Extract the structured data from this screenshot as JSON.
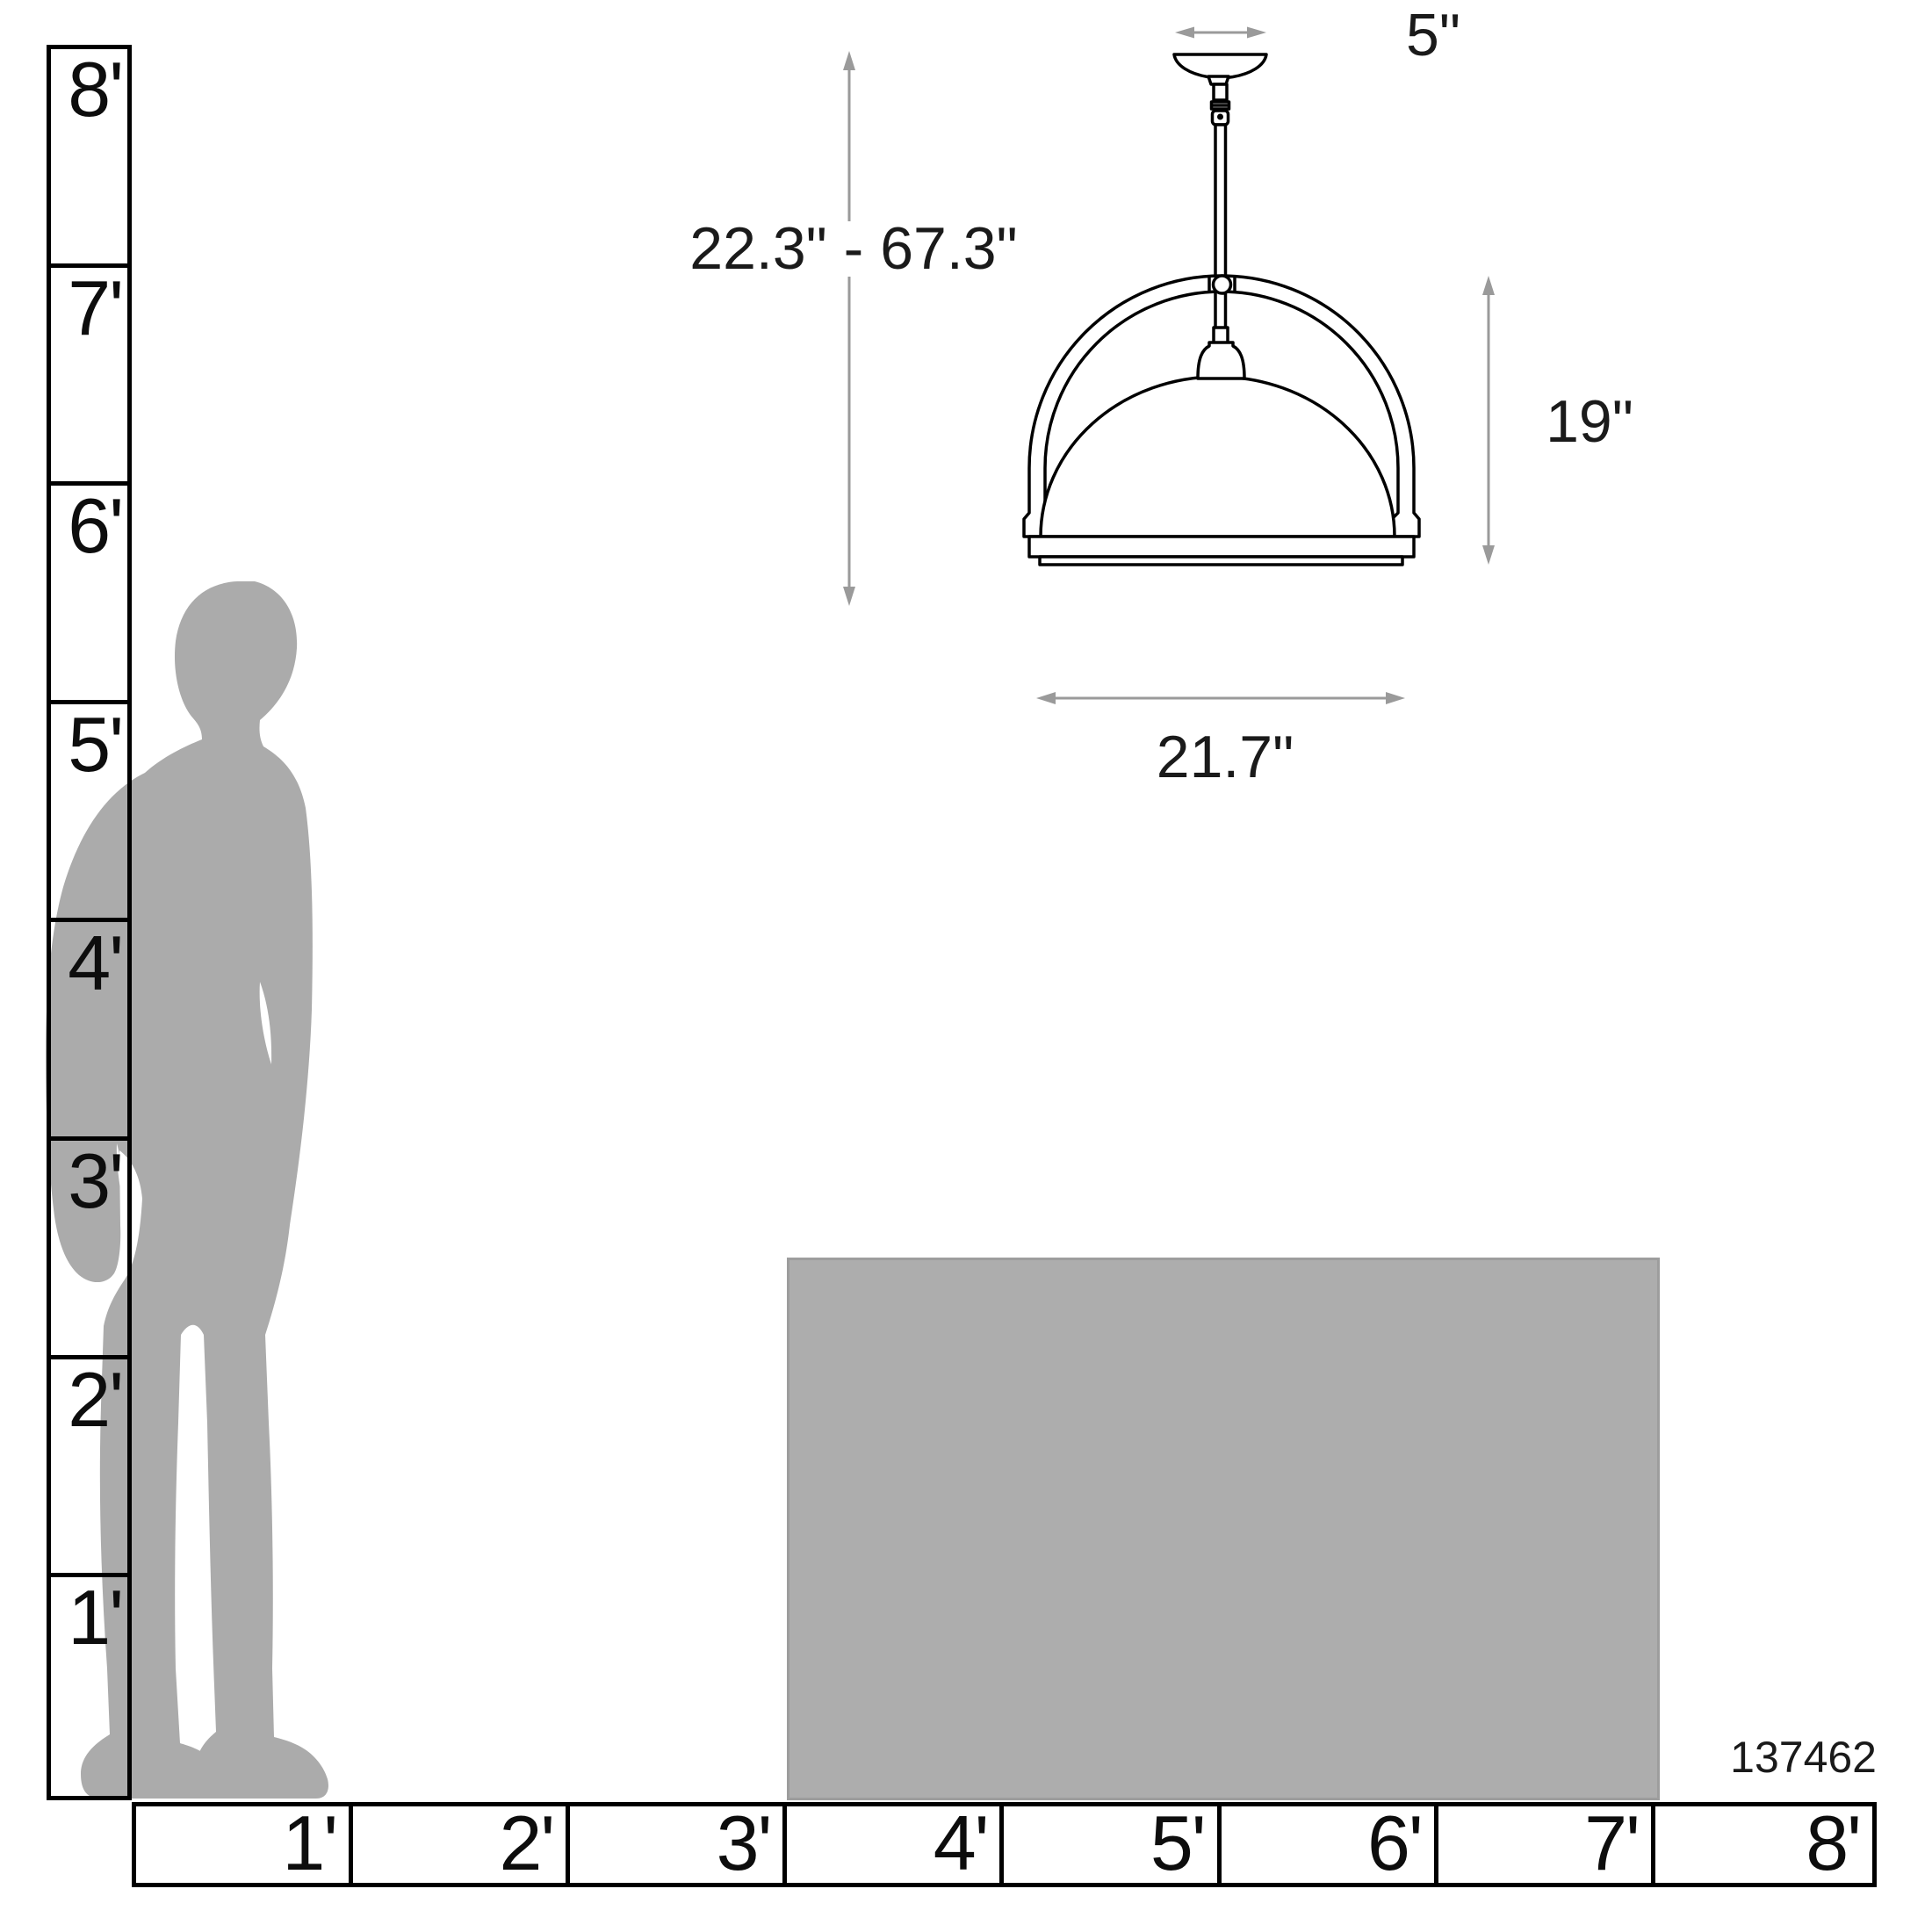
{
  "diagram_title": "pendant-light-size-reference-diagram",
  "colors": {
    "background": "#ffffff",
    "line_art": "#000000",
    "dimension_lines": "#9a9a9a",
    "text": "#1a1a1a",
    "silhouette_gray": "#ababab",
    "table_gray": "#adadad"
  },
  "vertical_ruler": {
    "unit": "feet",
    "labels": [
      "8'",
      "7'",
      "6'",
      "5'",
      "4'",
      "3'",
      "2'",
      "1'"
    ]
  },
  "horizontal_ruler": {
    "unit": "feet",
    "labels": [
      "1'",
      "2'",
      "3'",
      "4'",
      "5'",
      "6'",
      "7'",
      "8'"
    ]
  },
  "fixture": {
    "canopy_width_label": "5\"",
    "height_range_label": "22.3\" - 67.3\"",
    "fixture_height_label": "19\"",
    "fixture_width_label": "21.7\""
  },
  "product_id": "137462"
}
